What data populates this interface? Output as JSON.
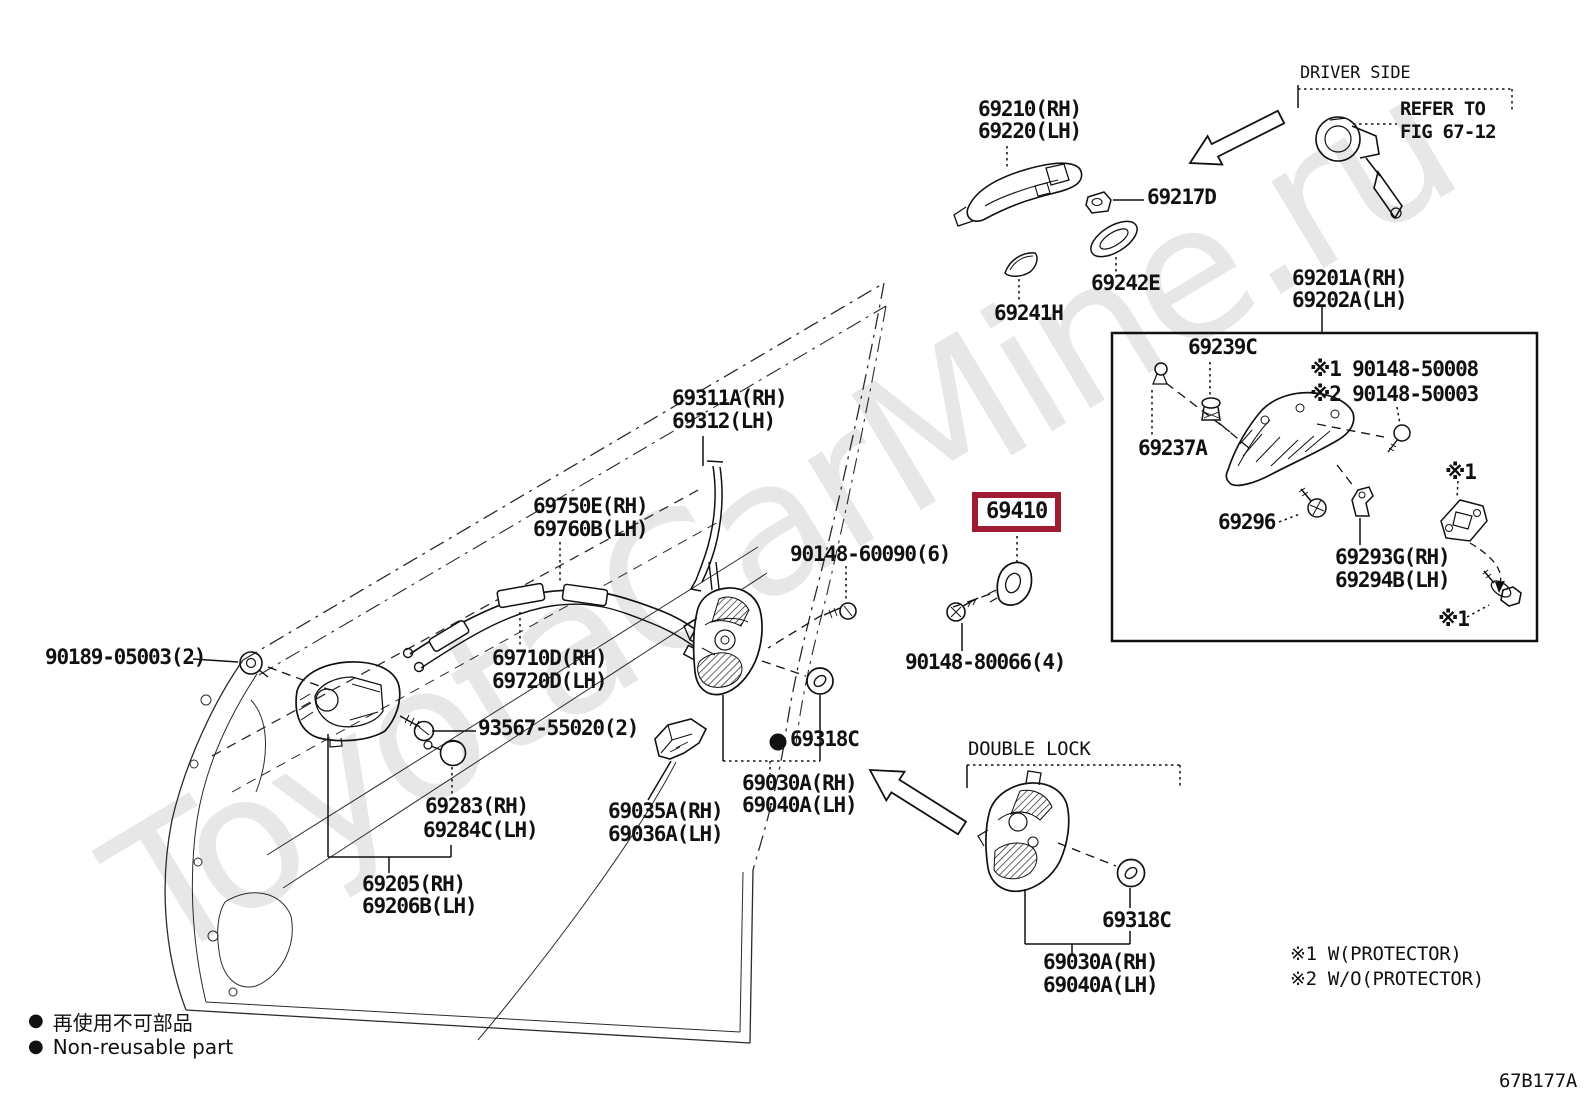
{
  "watermark": "ToyotaCarMine.ru",
  "figure_code": "67B177A",
  "highlight": {
    "part": "69410",
    "color": "#9e1b32"
  },
  "legend": {
    "marker": "●",
    "jp": "再使用不可部品",
    "en": "Non-reusable part"
  },
  "sections": {
    "driver_side": "DRIVER SIDE",
    "double_lock": "DOUBLE LOCK",
    "refer_to_line1": "REFER TO",
    "refer_to_line2": "FIG 67-12"
  },
  "notes": {
    "note1": "※1 W(PROTECTOR)",
    "note2": "※2 W/O(PROTECTOR)"
  },
  "labels": [
    {
      "name": "label-69210-rh",
      "text": "69210(RH)",
      "x": 978,
      "y": 98,
      "cls": "pn"
    },
    {
      "name": "label-69220-lh",
      "text": "69220(LH)",
      "x": 978,
      "y": 120,
      "cls": "pn"
    },
    {
      "name": "label-driver-side",
      "text": "DRIVER SIDE",
      "x": 1300,
      "y": 64,
      "cls": "cap-sm"
    },
    {
      "name": "label-refer-to",
      "text": "REFER TO",
      "x": 1400,
      "y": 99,
      "cls": "ref"
    },
    {
      "name": "label-fig-67-12",
      "text": "FIG 67-12",
      "x": 1400,
      "y": 122,
      "cls": "ref"
    },
    {
      "name": "label-69217d",
      "text": "69217D",
      "x": 1147,
      "y": 186,
      "cls": "pn"
    },
    {
      "name": "label-69242e",
      "text": "69242E",
      "x": 1091,
      "y": 272,
      "cls": "pn"
    },
    {
      "name": "label-69241h",
      "text": "69241H",
      "x": 994,
      "y": 302,
      "cls": "pn"
    },
    {
      "name": "label-69201a-rh",
      "text": "69201A(RH)",
      "x": 1292,
      "y": 267,
      "cls": "pn"
    },
    {
      "name": "label-69202a-lh",
      "text": "69202A(LH)",
      "x": 1292,
      "y": 289,
      "cls": "pn"
    },
    {
      "name": "label-69239c",
      "text": "69239C",
      "x": 1188,
      "y": 336,
      "cls": "pn"
    },
    {
      "name": "label-90148-50008",
      "text": "※1 90148-50008",
      "x": 1310,
      "y": 358,
      "cls": "pn"
    },
    {
      "name": "label-90148-50003",
      "text": "※2 90148-50003",
      "x": 1310,
      "y": 383,
      "cls": "pn"
    },
    {
      "name": "label-69237a",
      "text": "69237A",
      "x": 1138,
      "y": 437,
      "cls": "pn"
    },
    {
      "name": "label-69296",
      "text": "69296",
      "x": 1218,
      "y": 511,
      "cls": "pn"
    },
    {
      "name": "label-69293g-rh",
      "text": "69293G(RH)",
      "x": 1335,
      "y": 546,
      "cls": "pn"
    },
    {
      "name": "label-69294b-lh",
      "text": "69294B(LH)",
      "x": 1335,
      "y": 569,
      "cls": "pn"
    },
    {
      "name": "label-note1-upper",
      "text": "※1",
      "x": 1445,
      "y": 461,
      "cls": "pn"
    },
    {
      "name": "label-note1-lower",
      "text": "※1",
      "x": 1438,
      "y": 608,
      "cls": "pn"
    },
    {
      "name": "label-69311a-rh",
      "text": "69311A(RH)",
      "x": 672,
      "y": 387,
      "cls": "pn"
    },
    {
      "name": "label-69312-lh",
      "text": "69312(LH)",
      "x": 672,
      "y": 410,
      "cls": "pn"
    },
    {
      "name": "label-69750e-rh",
      "text": "69750E(RH)",
      "x": 533,
      "y": 495,
      "cls": "pn"
    },
    {
      "name": "label-69760b-lh",
      "text": "69760B(LH)",
      "x": 533,
      "y": 518,
      "cls": "pn"
    },
    {
      "name": "label-90148-60090",
      "text": "90148-60090(6)",
      "x": 790,
      "y": 543,
      "cls": "pn"
    },
    {
      "name": "label-90148-80066",
      "text": "90148-80066(4)",
      "x": 905,
      "y": 651,
      "cls": "pn"
    },
    {
      "name": "label-69710d-rh",
      "text": "69710D(RH)",
      "x": 492,
      "y": 647,
      "cls": "pn"
    },
    {
      "name": "label-69720d-lh",
      "text": "69720D(LH)",
      "x": 492,
      "y": 670,
      "cls": "pn"
    },
    {
      "name": "label-93567-55020",
      "text": "93567-55020(2)",
      "x": 478,
      "y": 717,
      "cls": "pn"
    },
    {
      "name": "label-69283-rh",
      "text": "69283(RH)",
      "x": 425,
      "y": 795,
      "cls": "pn"
    },
    {
      "name": "label-69284c-lh",
      "text": "69284C(LH)",
      "x": 423,
      "y": 819,
      "cls": "pn"
    },
    {
      "name": "label-69035a-rh",
      "text": "69035A(RH)",
      "x": 608,
      "y": 800,
      "cls": "pn"
    },
    {
      "name": "label-69036a-lh",
      "text": "69036A(LH)",
      "x": 608,
      "y": 823,
      "cls": "pn"
    },
    {
      "name": "label-69205-rh",
      "text": "69205(RH)",
      "x": 362,
      "y": 873,
      "cls": "pn"
    },
    {
      "name": "label-69206b-lh",
      "text": "69206B(LH)",
      "x": 362,
      "y": 895,
      "cls": "pn"
    },
    {
      "name": "label-90189-05003",
      "text": "90189-05003(2)",
      "x": 45,
      "y": 646,
      "cls": "pn"
    },
    {
      "name": "label-69318c-main",
      "text": "69318C",
      "x": 790,
      "y": 728,
      "cls": "pn"
    },
    {
      "name": "label-69030a-rh-main",
      "text": "69030A(RH)",
      "x": 742,
      "y": 772,
      "cls": "pn"
    },
    {
      "name": "label-69040a-lh-main",
      "text": "69040A(LH)",
      "x": 742,
      "y": 794,
      "cls": "pn"
    },
    {
      "name": "label-double-lock",
      "text": "DOUBLE LOCK",
      "x": 968,
      "y": 739,
      "cls": "cap"
    },
    {
      "name": "label-69318c-double-lock",
      "text": "69318C",
      "x": 1102,
      "y": 909,
      "cls": "pn"
    },
    {
      "name": "label-69030a-rh-double-lock",
      "text": "69030A(RH)",
      "x": 1043,
      "y": 951,
      "cls": "pn"
    },
    {
      "name": "label-69040a-lh-double-lock",
      "text": "69040A(LH)",
      "x": 1043,
      "y": 974,
      "cls": "pn"
    },
    {
      "name": "label-note-protector-1",
      "text": "※1 W(PROTECTOR)",
      "x": 1290,
      "y": 944,
      "cls": "cap"
    },
    {
      "name": "label-note-protector-2",
      "text": "※2 W/O(PROTECTOR)",
      "x": 1290,
      "y": 969,
      "cls": "cap"
    },
    {
      "name": "label-figure-code",
      "text": "67B177A",
      "x": 1499,
      "y": 1071,
      "cls": "cap"
    }
  ]
}
